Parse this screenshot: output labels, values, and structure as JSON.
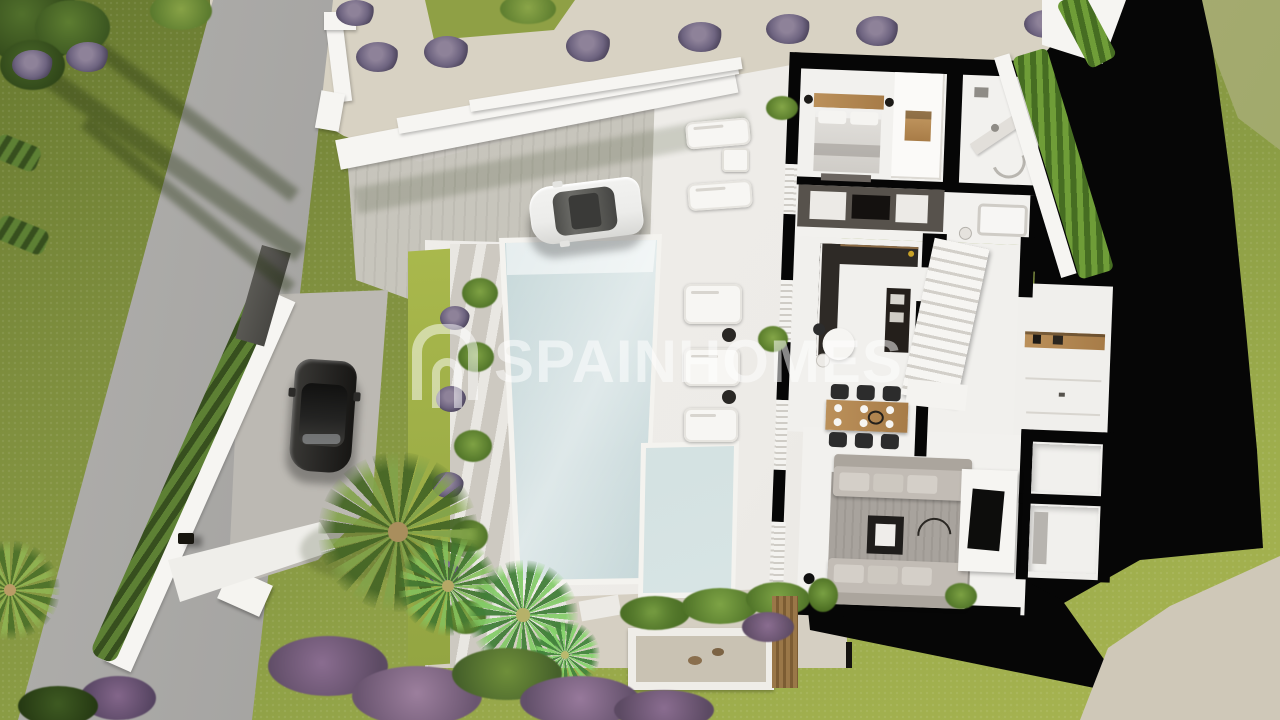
{
  "watermark": {
    "brand": "SPAINHOMES",
    "logo": "spainhomes-arch-logo"
  },
  "palette": {
    "grass_base": "#7e8e3e",
    "grass_light": "#a2b14e",
    "road": "#a2a19f",
    "gravel": "#d8d2c3",
    "paver": "#c8c5bf",
    "terrace": "#edebe7",
    "wall_white": "#f6f5f2",
    "pool_water": "#c7d8da",
    "pool_light": "#e6eeee",
    "shadow_black": "#060606",
    "hedge": "#6f9d38",
    "hedge_dark": "#466d22",
    "lavender": "#73687f",
    "wood": "#bb905a",
    "charcoal": "#2e2a26",
    "sofa": "#c2bcb5",
    "rug": "#a8a39d",
    "car_white": "#ececea",
    "car_black": "#262523"
  }
}
